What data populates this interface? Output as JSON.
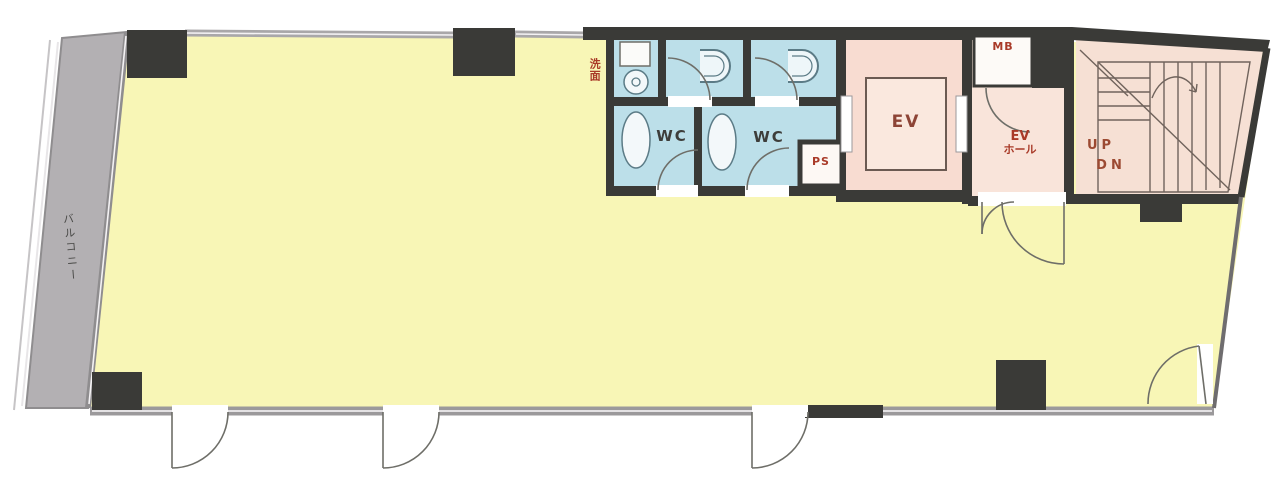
{
  "floorplan": {
    "title": "building-floor-plan",
    "labels": {
      "balcony": "バルコニー",
      "washroom": "洗面",
      "wc_left": "WC",
      "wc_right": "WC",
      "ps": "PS",
      "elevator": "EV",
      "meter_box": "MB",
      "ev_hall_line1": "EV",
      "ev_hall_line2": "ホール",
      "stairs_up": "UP",
      "stairs_down": "DN"
    },
    "colors": {
      "wall": "#3a3a37",
      "main_room_yellow": "#f8f6b6",
      "wet_area_blue": "#bcdfe9",
      "elevator_pink": "#f8dcd1",
      "hall_pink": "#f9e4da",
      "stairs_pink": "#f6e0d4",
      "balcony_gray": "#b3b0b3",
      "window_gray": "#9b999b",
      "label_red": "#a93a28",
      "label_dark": "#3d3d3a"
    }
  }
}
